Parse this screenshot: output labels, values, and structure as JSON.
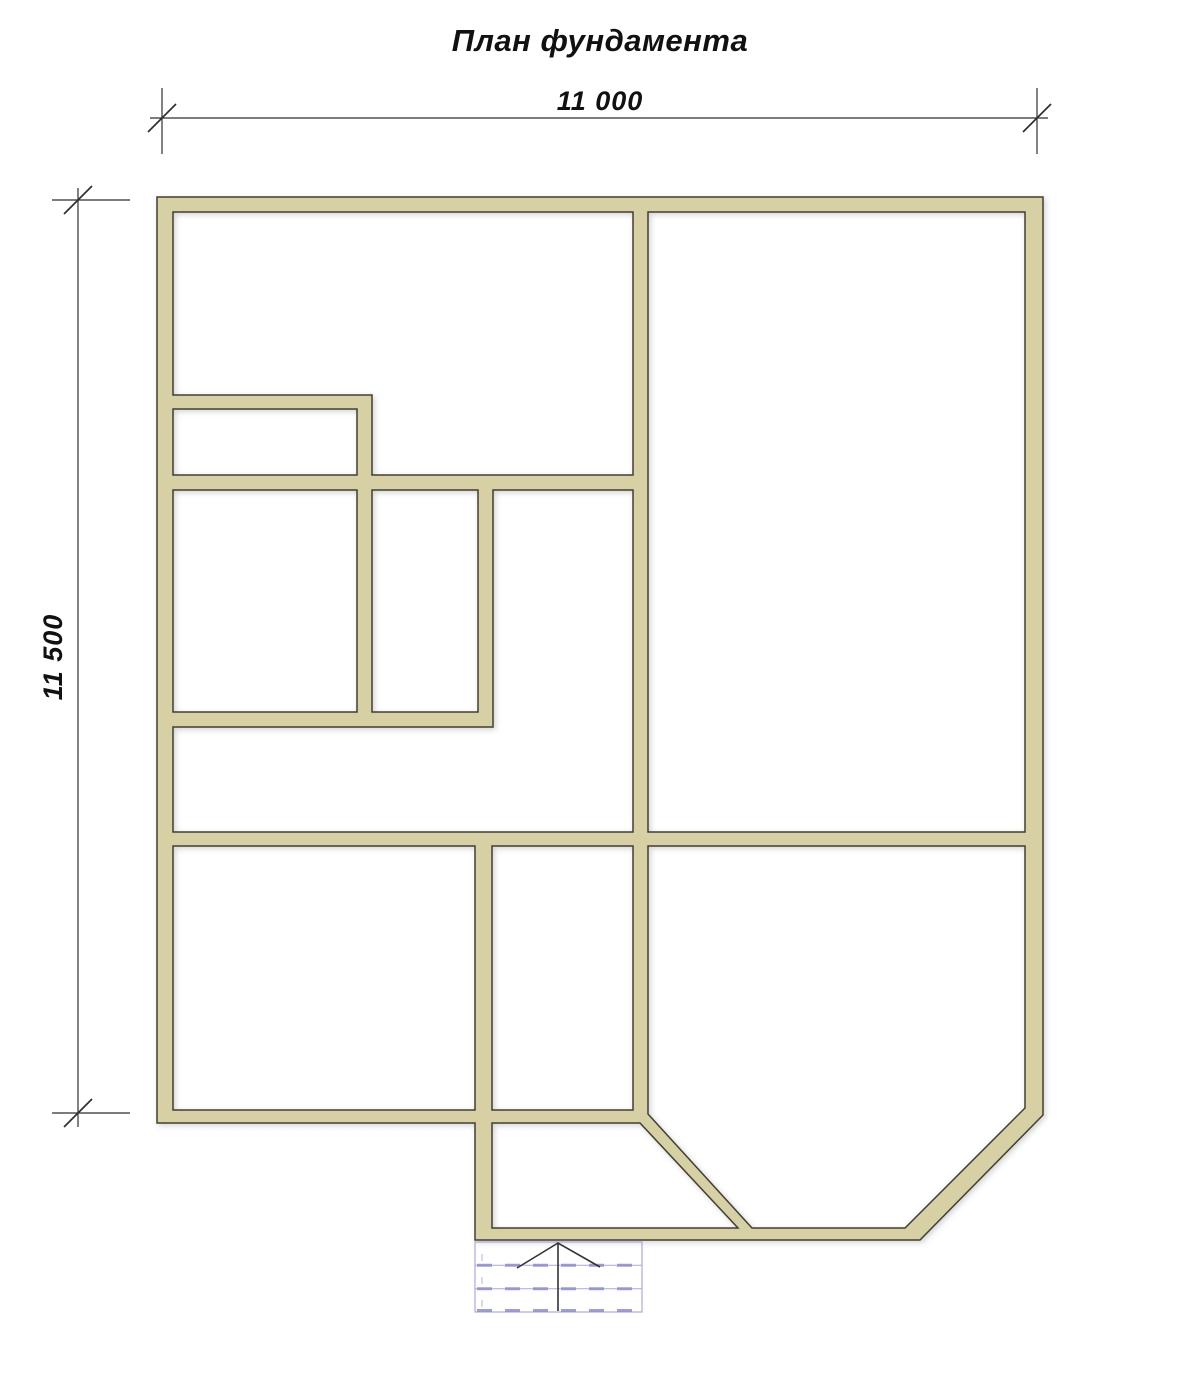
{
  "title": "План фундамента",
  "dimensions": {
    "horizontal": {
      "label": "11 000"
    },
    "vertical": {
      "label": "11 500"
    }
  },
  "stairs": {
    "steps": 3,
    "arrow_direction": "up"
  },
  "colors": {
    "background": "#ffffff",
    "wall_fill": "#d6d0a4",
    "wall_outline": "#413f33",
    "dimension_line": "#2e2e2e",
    "text": "#111111",
    "stairs_outline": "#a9a9df",
    "stairs_dash": "#8d8dd4",
    "arrow": "#333333"
  }
}
